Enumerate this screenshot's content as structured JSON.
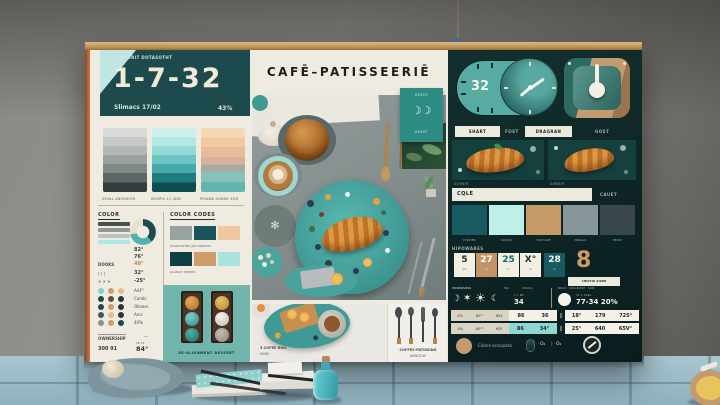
{
  "scene_description": "Café-patisserie brand mood board leaning on a gray concrete wall above a light-blue wooden table",
  "palette": {
    "board_bg": "#efebe0",
    "header_teal": "#1d4a4c",
    "panel_dark": "#0e2425",
    "teal": "#4fb0aa",
    "aqua": "#aee8e2",
    "mint": "#bff0e8",
    "tan": "#c49b6e",
    "peach": "#f0c8a0",
    "slate": "#39464a",
    "gray_blue": "#87969b",
    "cream": "#ece9dd",
    "accent_orange": "#c87848",
    "table_wood": "#9fc0cb"
  },
  "board": {
    "title": "CAFĒ–PATISSEERIĒ",
    "left": {
      "header_caption": "SACCURIT DOTASOTHT",
      "big_number": "1-7-32",
      "sub_left": "Slimacs 17/02",
      "sub_right": "43%",
      "gradient_captions": [
        "AYVAL ANOKXIOR",
        "AOKPIA 11 JIDN",
        "PIOKNE AOKNE 3QN"
      ],
      "color_label": "COLOR",
      "color_values": [
        "82°",
        "76°"
      ],
      "stat_rows": [
        {
          "label": "DOOKS",
          "value": "48°"
        },
        {
          "label": "⟨ ⟩ ⟩",
          "value": "32°"
        },
        {
          "label": "✕ ✕ ✕",
          "value": "-25°"
        }
      ],
      "codes_label": "COLOR CODES",
      "codes_caption_1": "HANDCRTTED JAR ORNISHS",
      "codes_caption_2": "ACANIAT PIRRTIR",
      "legend_lines": [
        "AAF°",
        "Camb:",
        "Obsess",
        "Arcs",
        "40%"
      ],
      "ownership_label": "OWNERSHIP",
      "ownership_dash": "—",
      "ownership_value": "300  91",
      "ownership_sup": "SE 14",
      "ownership_deg": "84°",
      "dessert_caption": "RE-ALIGNMENT DESSERT"
    },
    "center": {
      "moon_tile_top": "GOIST",
      "moon_tile_icon": "☽☽",
      "moon_tile_bottom": "GGHIT",
      "caption_left_1": "3 COFEE ROIL",
      "caption_left_2": "WINE",
      "caption_right_1": "COFFES-PATISSING",
      "caption_right_2": "WINDOW"
    },
    "right": {
      "clock_value": "32",
      "labels_row": [
        "SHART",
        "FOST",
        "DRAGRAN",
        "GOST"
      ],
      "photo_captions": [
        "SOMER",
        "AMBER"
      ],
      "cafe_label": "CQLE",
      "cafe_right": "CAUET",
      "swatch_captions": [
        "DIVIDER",
        "GOODS",
        "ROYCAVE",
        "SMALLS",
        "HEAVY"
      ],
      "tiles_label": "HIPOWARES",
      "tiles": [
        {
          "value": "5",
          "sub": "am"
        },
        {
          "value": "27",
          "sub": "m"
        },
        {
          "value": "25",
          "sub": "tt"
        },
        {
          "value": "X°",
          "sub": "w"
        },
        {
          "value": "28",
          "sub": "m"
        }
      ],
      "big_number": "8",
      "big_number_caption": "CHISTOI SIGER",
      "weather": {
        "label": "PROWARSS",
        "label_inc": "INC",
        "label_visual": "VISUAL",
        "icons": [
          "☽",
          "✶",
          "☀",
          "☾"
        ],
        "small": "1 1 BX",
        "value": "34",
        "right_labels": "BOLD · DIAGNOSE · SUN",
        "right_small": "11 1 1990",
        "right_value": "77-34 20%"
      },
      "table": {
        "rows": [
          {
            "left": [
              "0%",
              "80¹¹",
              "604"
            ],
            "mid": [
              "86",
              "36"
            ],
            "sep": "||",
            "right": [
              "18°",
              "179",
              "725°"
            ]
          },
          {
            "left": [
              "0%",
              "80¹¹",
              "60F"
            ],
            "mid": [
              "86",
              "34°"
            ],
            "sep": "||",
            "right": [
              "25°",
              "640",
              "65V°"
            ]
          }
        ]
      },
      "footer": {
        "text": "Colore ecosipatis",
        "o2": "O₂",
        "sep": "|",
        "o1": "O₁"
      }
    }
  }
}
